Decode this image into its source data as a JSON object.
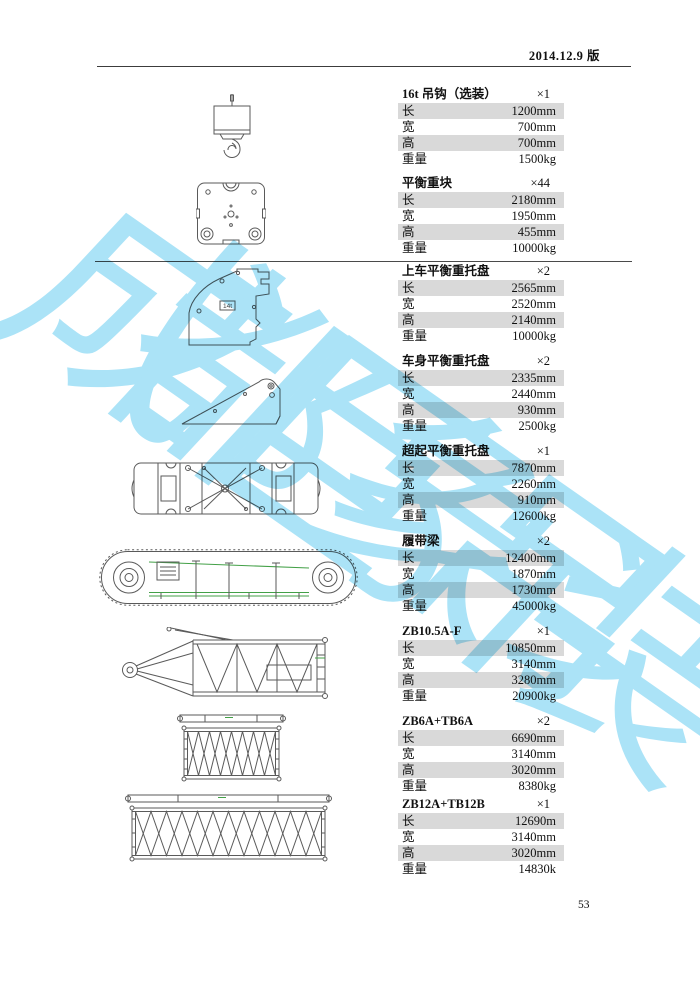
{
  "header": {
    "version": "2014.12.9 版"
  },
  "footer": {
    "page_number": "53"
  },
  "watermark": {
    "text": "成都巨象吊装"
  },
  "colors": {
    "row_shade": "#d9d9d9",
    "watermark_blue": "#abe3f7",
    "drawing_green": "#43a047"
  },
  "row_labels": {
    "length": "长",
    "width": "宽",
    "height": "高",
    "weight": "重量"
  },
  "sections": [
    {
      "title": "16t 吊钩（选装）",
      "qty": "×1",
      "length": "1200mm",
      "width": "700mm",
      "height": "700mm",
      "weight": "1500kg"
    },
    {
      "title": "平衡重块",
      "qty": "×44",
      "length": "2180mm",
      "width": "1950mm",
      "height": "455mm",
      "weight": "10000kg"
    },
    {
      "title": "上车平衡重托盘",
      "qty": "×2",
      "length": "2565mm",
      "width": "2520mm",
      "height": "2140mm",
      "weight": "10000kg",
      "drawing_label": "14t"
    },
    {
      "title": "车身平衡重托盘",
      "qty": "×2",
      "length": "2335mm",
      "width": "2440mm",
      "height": "930mm",
      "weight": "2500kg"
    },
    {
      "title": "超起平衡重托盘",
      "qty": "×1",
      "length": "7870mm",
      "width": "2260mm",
      "height": "910mm",
      "weight": "12600kg"
    },
    {
      "title": "履带梁",
      "qty": "×2",
      "length": "12400mm",
      "width": "1870mm",
      "height": "1730mm",
      "weight": "45000kg"
    },
    {
      "title": "ZB10.5A-F",
      "qty": "×1",
      "length": "10850mm",
      "width": "3140mm",
      "height": "3280mm",
      "weight": "20900kg"
    },
    {
      "title": "ZB6A+TB6A",
      "qty": "×2",
      "length": "6690mm",
      "width": "3140mm",
      "height": "3020mm",
      "weight": "8380kg"
    },
    {
      "title": "ZB12A+TB12B",
      "qty": "×1",
      "length": "12690m",
      "width": "3140mm",
      "height": "3020mm",
      "weight": "14830k"
    }
  ]
}
